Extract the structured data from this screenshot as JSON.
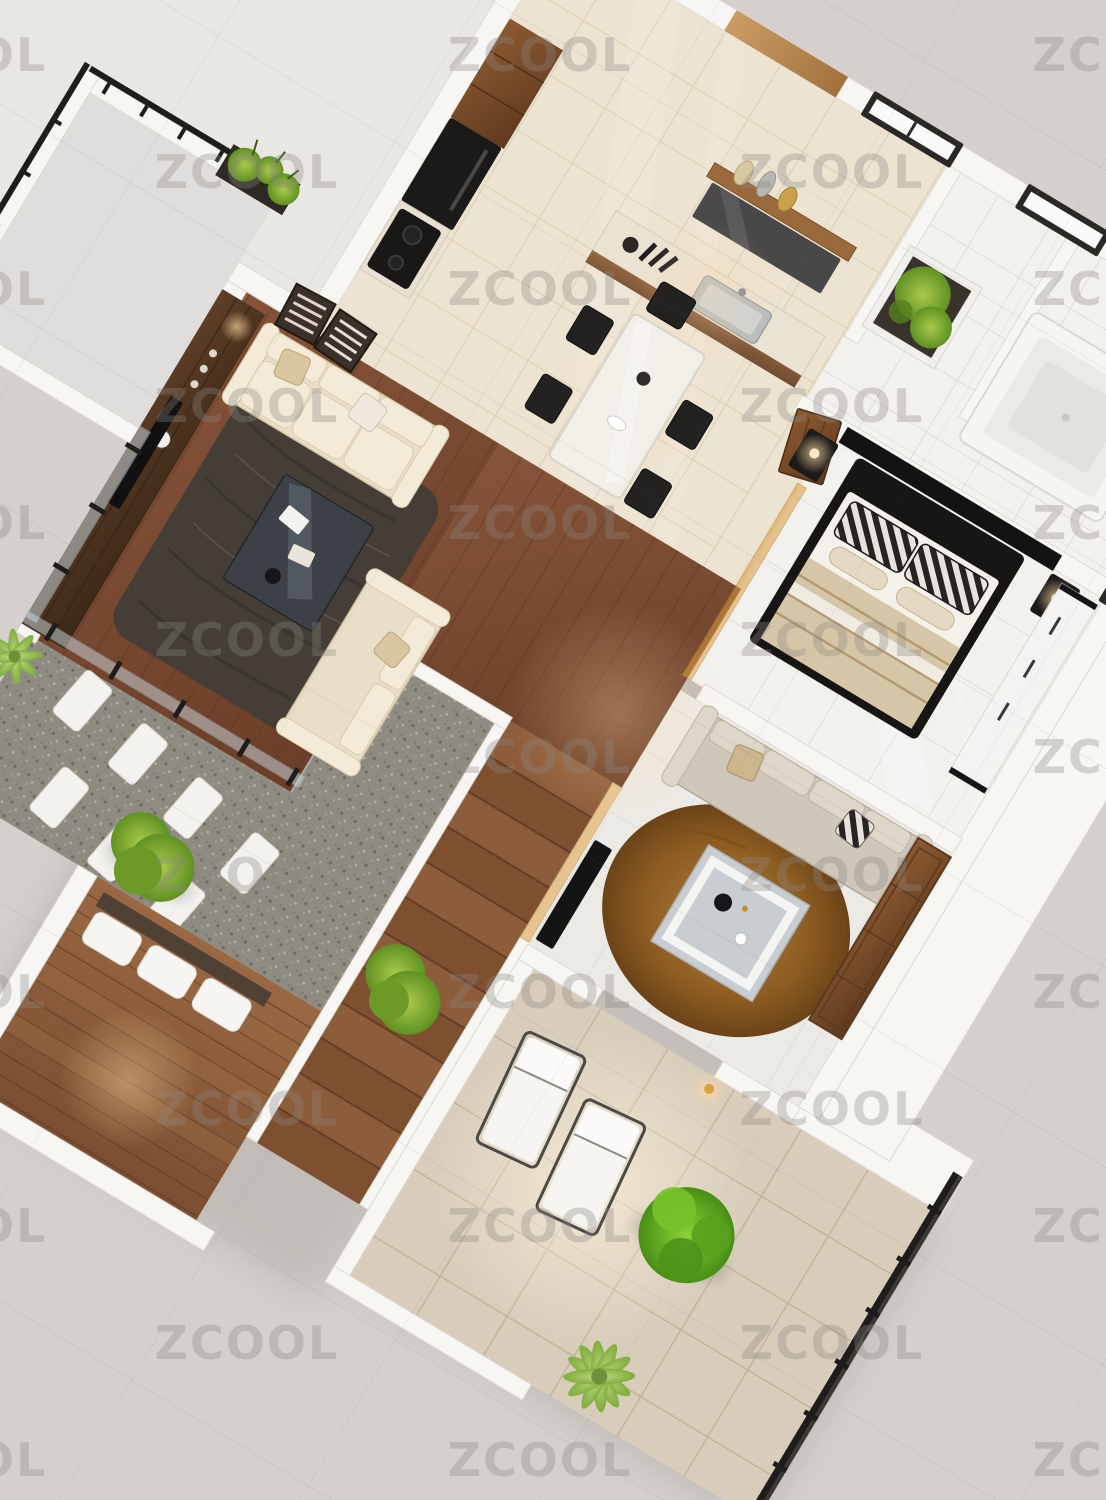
{
  "watermark": {
    "text": "ZCOOL"
  },
  "scene": {
    "type": "3d-isometric-apartment-floor-plan-render",
    "areas": [
      "balcony",
      "kitchen",
      "dining-area",
      "living-room",
      "hallway",
      "bedroom",
      "bathroom",
      "family-lounge",
      "stairs",
      "gravel-garden",
      "wood-deck",
      "patio-terrace"
    ]
  },
  "palette": {
    "background": "#d5d0cb",
    "watermark_gray": "#8c8782",
    "roof_plane": "#e9e7e4",
    "wall_white": "#f7f6f3",
    "floor_cream": "#ece3d1",
    "floor_white": "#f2f1ee",
    "floor_lounge": "#eceae5",
    "patio_tile": "#d8cdbb",
    "gravel": "#8e8b81",
    "stone_white": "#f3f2ef",
    "railing_black": "#1e1d1c",
    "glass_blue": "#ccdde6",
    "glass_amber": "#d99a3f",
    "sofa_cream": "#e9dfc8",
    "sofa_taupe": "#cfc7ba",
    "rug_dark": "#443e37",
    "rug_amber": "#a06a24",
    "coffee_table_dark": "#3d4147",
    "coffee_table_gray": "#c8cdd2",
    "bed_black": "#171615",
    "bedding_white": "#f4f1ea",
    "bedding_beige": "#d6c6a8",
    "appliance_black": "#1c1a19",
    "cabinet_wood": "#7b4a28",
    "walnut_wall": "#573823",
    "wood_floor": "#7c4b31",
    "deck_wood": "#8f5f3e",
    "green_bush": "#79a52f",
    "green_tree": "#63a824",
    "green_palm": "#9cbf62"
  }
}
